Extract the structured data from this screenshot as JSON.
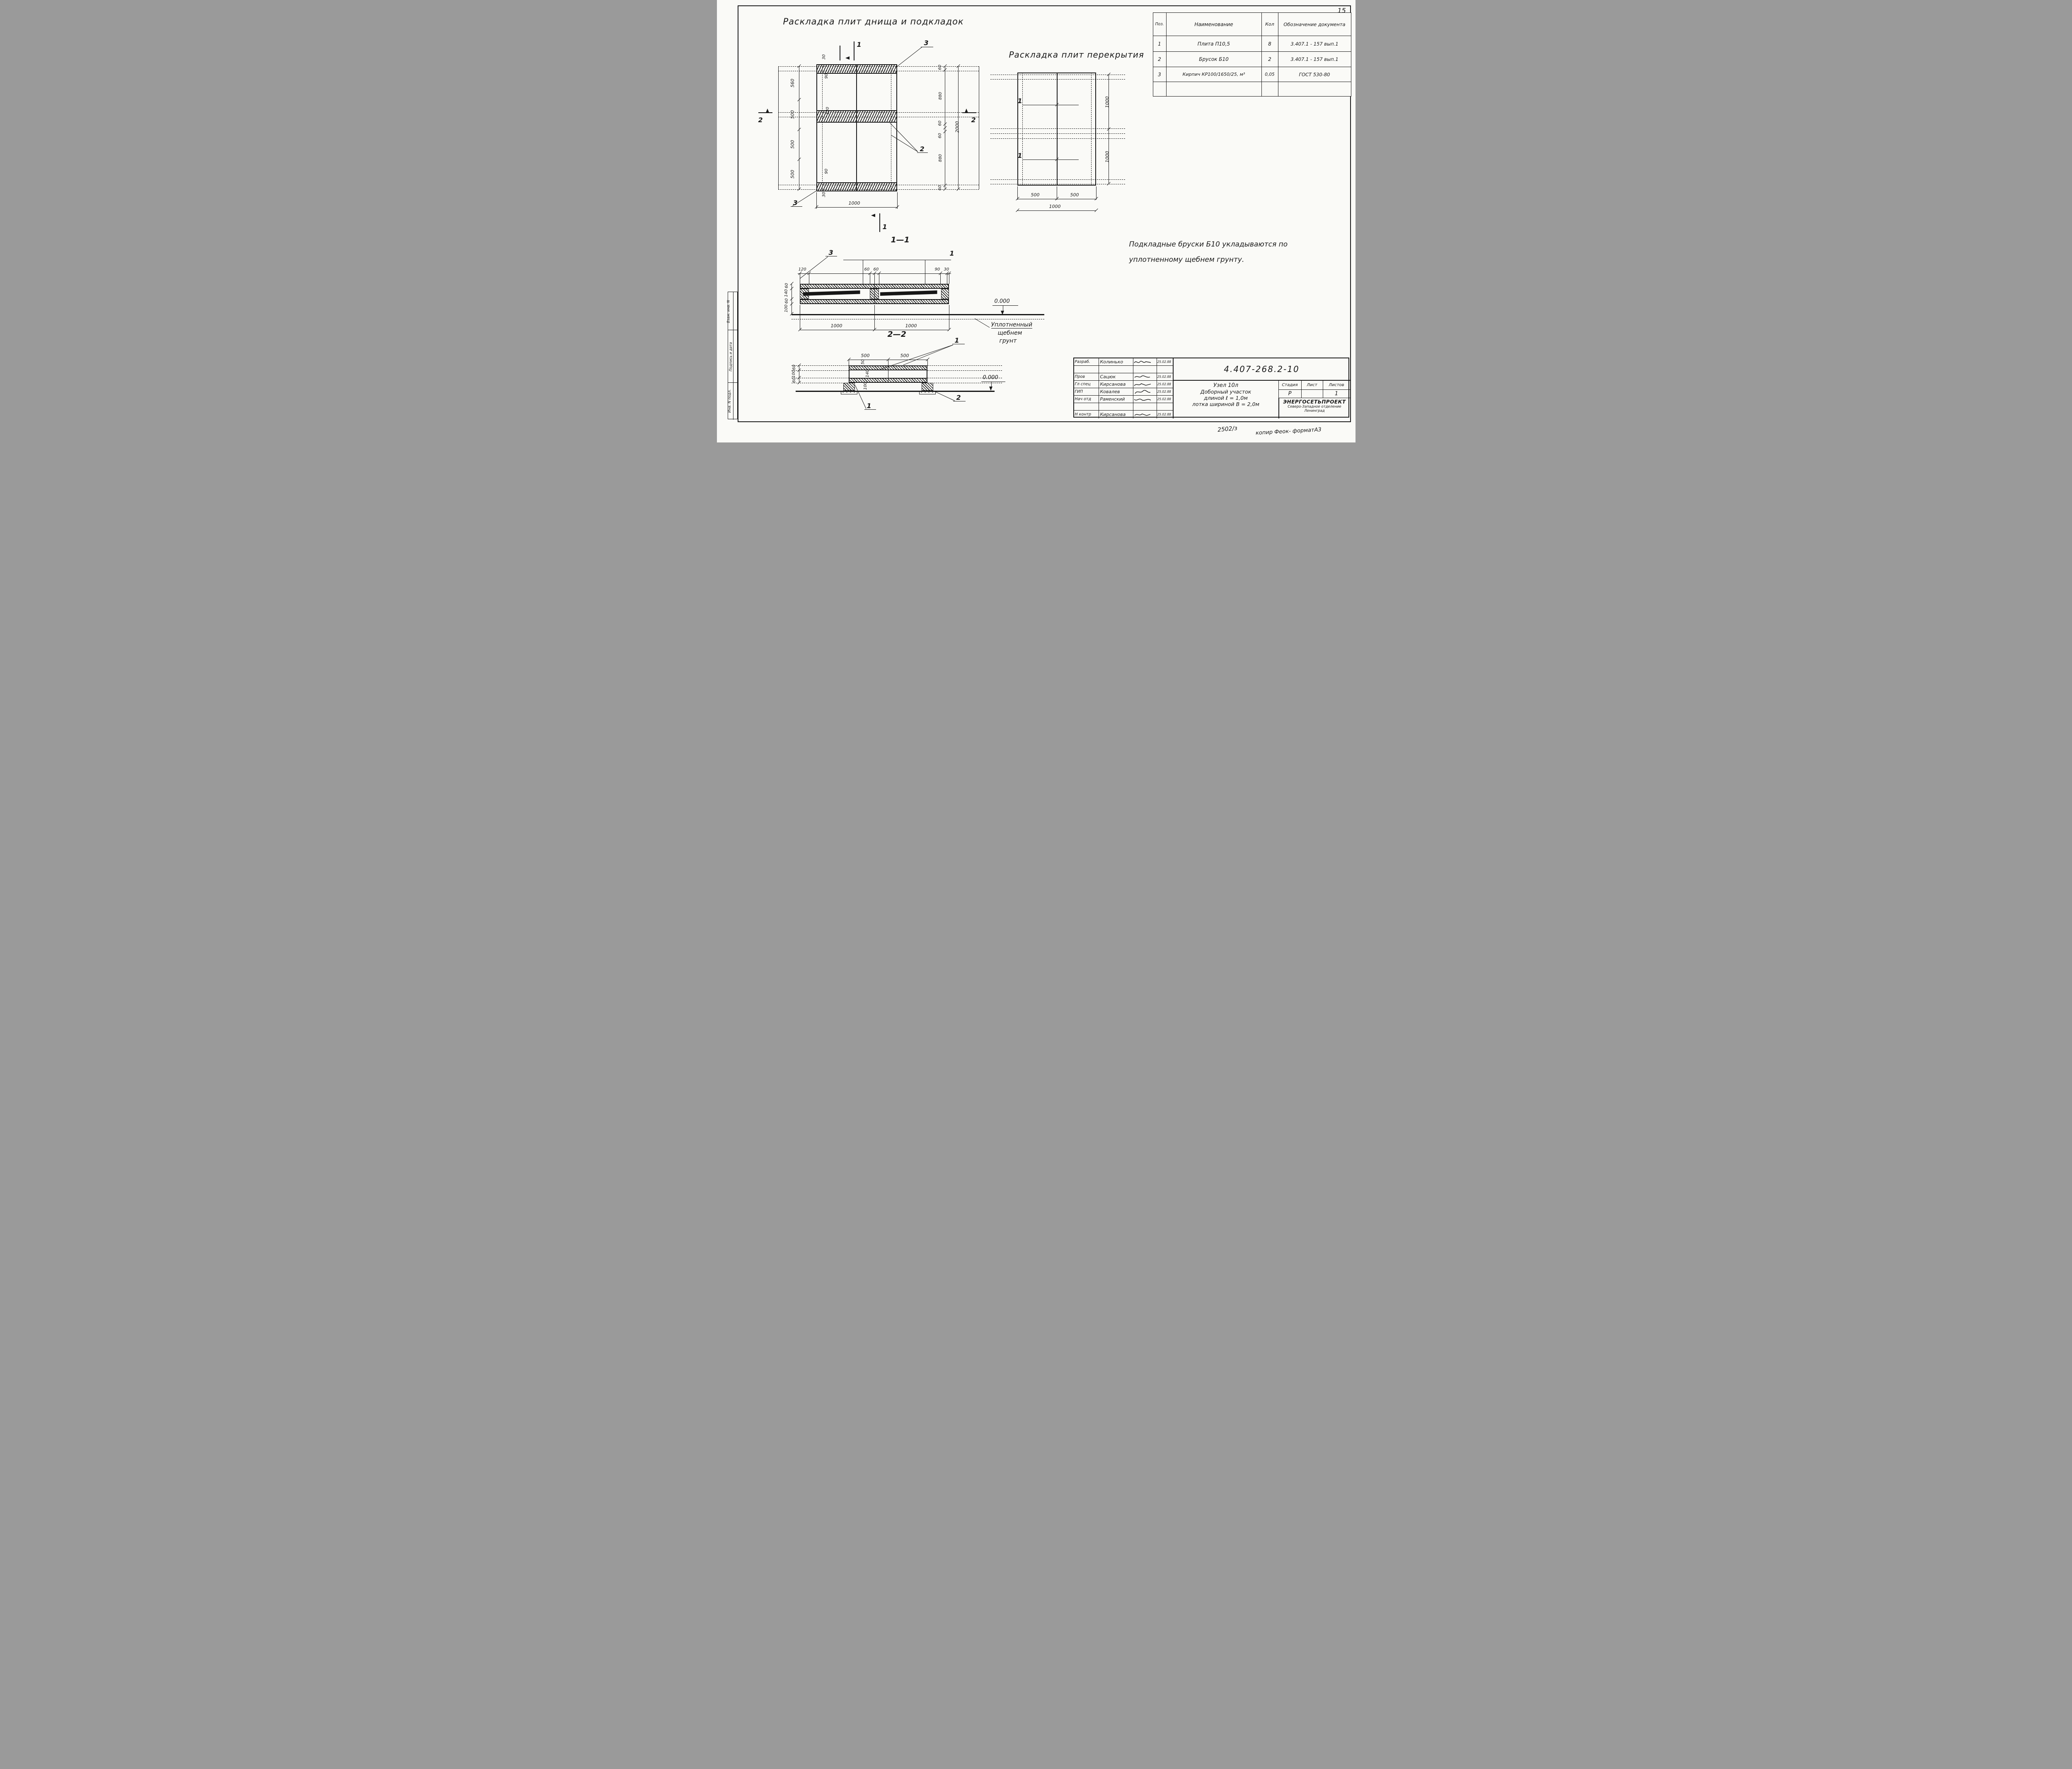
{
  "page": {
    "number": "15",
    "footer_left": "2502/з",
    "footer_right": "копир Феок- форматА3"
  },
  "sidebar": {
    "cells": [
      "Взам. инв. N",
      "Подпись и дата",
      "Инв. N подл."
    ]
  },
  "plan1": {
    "title": "Раскладка плит днища и подкладок",
    "marker_v": "1",
    "marker_h": "2",
    "callout_top": "3",
    "callout_mid": "2",
    "callout_bottom": "3",
    "dims_left": [
      "560",
      "500",
      "500",
      "500"
    ],
    "dims_right": [
      "60",
      "880",
      "60",
      "60",
      "880",
      "60"
    ],
    "dim_total": "2000",
    "dim_bottom": "1000",
    "dims_inner": [
      "30",
      "90",
      "120",
      "90",
      "30"
    ]
  },
  "plan2": {
    "title": "Раскладка плит перекрытия",
    "callout": "1",
    "dims_right": [
      "1000",
      "1000"
    ],
    "dims_bottom": [
      "500",
      "500"
    ],
    "dim_total": "1000"
  },
  "parts": {
    "headers": [
      "Поз.",
      "Наименование",
      "Кол",
      "Обозначение документа"
    ],
    "rows": [
      [
        "1",
        "Плита  П10,5",
        "8",
        "3.407.1 - 157 вып.1"
      ],
      [
        "2",
        "Брусок  Б10",
        "2",
        "3.407.1 - 157 вып.1"
      ],
      [
        "3",
        "Кирпич КР100/1650/25, м³",
        "0,05",
        "ГОСТ 530-80"
      ]
    ]
  },
  "note": {
    "l1": "Подкладные  бруски  Б10  укладываются  по",
    "l2": "уплотненному  щебнем  грунту."
  },
  "sec1": {
    "title": "1—1",
    "callout_left": "3",
    "callout_right": "1",
    "dims_top": [
      "120",
      "60",
      "60",
      "90",
      "30"
    ],
    "dims_left": [
      "60",
      "140",
      "60",
      "100"
    ],
    "dims_bottom": [
      "1000",
      "1000"
    ],
    "level": "0.000",
    "ground": [
      "Уплотненный",
      "щебнем",
      "грунт"
    ]
  },
  "sec2": {
    "title": "2—2",
    "callout_top": "1",
    "callout_bottom": "1",
    "callout_right": "2",
    "dims_top": [
      "500",
      "500"
    ],
    "dims_left": [
      "60",
      "100",
      "60"
    ],
    "dims_inner": [
      "50",
      "140",
      "100"
    ],
    "level": "0.000"
  },
  "stamp": {
    "doc_number": "4.407-268.2-10",
    "rows": [
      {
        "role": "Разраб.",
        "name": "Колинько",
        "date": "25.02.88"
      },
      {
        "role": "",
        "name": "",
        "date": ""
      },
      {
        "role": "Пров",
        "name": "Сацюк",
        "date": "25.02.88"
      },
      {
        "role": "Гл спец",
        "name": "Кирсанова",
        "date": "25.02.88"
      },
      {
        "role": "ГИП",
        "name": "Ковалев",
        "date": "25.02.88"
      },
      {
        "role": "Нач отд",
        "name": "Раменский",
        "date": "25.02.88"
      },
      {
        "role": "",
        "name": "",
        "date": ""
      },
      {
        "role": "Н контр",
        "name": "Кирсанова",
        "date": "25.02.88"
      }
    ],
    "title_lines": [
      "Узел 10л",
      "Доборный участок",
      "длиной ℓ = 1,0м",
      "лотка шириной В = 2,0м"
    ],
    "stage_label": "Стадия",
    "sheet_label": "Лист",
    "sheets_label": "Листов",
    "stage": "Р",
    "sheet": "",
    "sheets": "1",
    "org1": "ЭНЕРГОСЕТЬПРОЕКТ",
    "org2": "Северо-Западное отделение",
    "org3": "Ленинград"
  }
}
